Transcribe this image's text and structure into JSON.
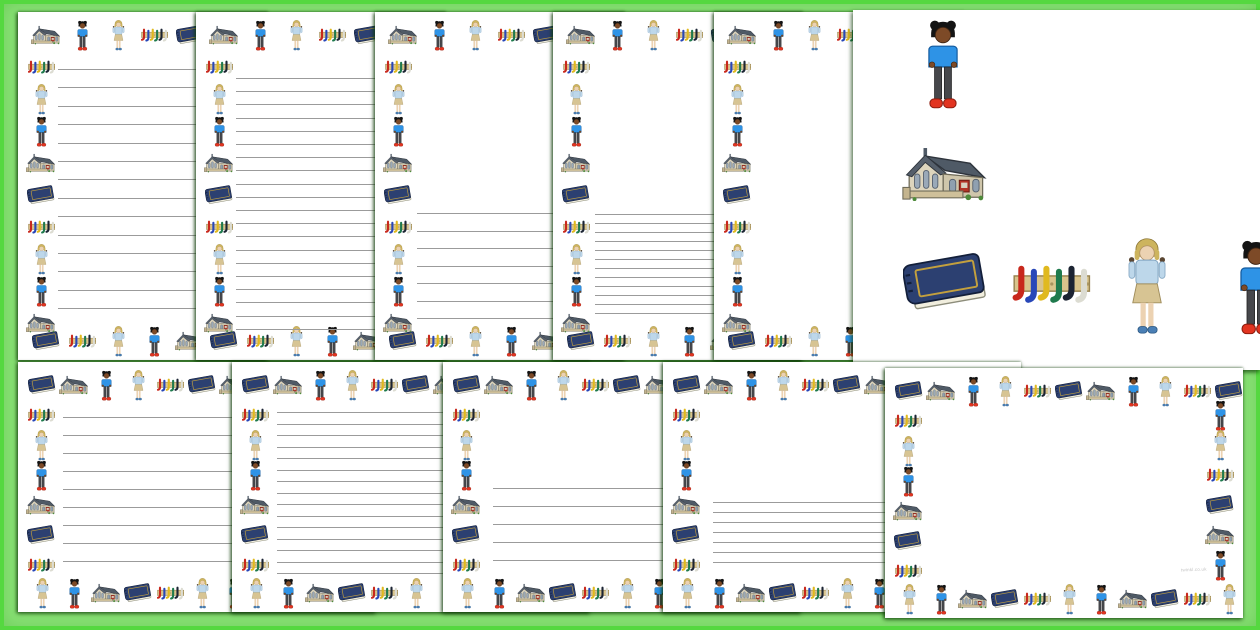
{
  "watermark": "twinkl.co.uk",
  "background": {
    "fill": "#8ae276",
    "frame": "#55d840",
    "page_color": "#ffffff",
    "line_color": "#9b9b9b"
  },
  "icon_cycle": [
    "school",
    "boy",
    "kid",
    "crayons",
    "book"
  ],
  "icon_legend": {
    "school": "school-building",
    "boy": "boy-blue-jumper-red-shoes",
    "kid": "child-waving-blonde",
    "crayons": "peg-rail-coloured-hooks",
    "book": "blue-book"
  },
  "border_templates": {
    "portrait": {
      "top": {
        "start": 0,
        "dir": 1,
        "count": 7,
        "cell": 36,
        "pad": 10
      },
      "left": {
        "start": 3,
        "dir": -1,
        "count": 9,
        "y": 40,
        "step": 32
      },
      "bottom": {
        "start": 4,
        "dir": -1,
        "count": 7,
        "cell": 36,
        "pad": 10
      }
    },
    "landscape": {
      "top": {
        "start": 4,
        "dir": 1,
        "count": 11,
        "cell": 32,
        "pad": 8
      },
      "left": {
        "start": 3,
        "dir": -1,
        "count": 6,
        "y": 38,
        "step": 30
      },
      "bottom": {
        "start": 2,
        "dir": -1,
        "count": 11,
        "cell": 32,
        "pad": 8
      }
    },
    "landscape_full": {
      "top": {
        "start": 4,
        "dir": 1,
        "count": 11,
        "cell": 32,
        "pad": 8
      },
      "left": {
        "start": 3,
        "dir": -1,
        "count": 6,
        "y": 38,
        "step": 30
      },
      "bottom": {
        "start": 2,
        "dir": -1,
        "count": 11,
        "cell": 32,
        "pad": 8
      },
      "right": {
        "start": 1,
        "dir": 1,
        "count": 6,
        "y": 32,
        "step": 30
      }
    }
  },
  "pages": [
    {
      "name": "portrait-wide-lines",
      "left": 18,
      "top": 12,
      "width": 250,
      "height": 348,
      "z": 1,
      "template": "portrait",
      "lines": {
        "count": 14,
        "start": 57,
        "step": 18.4,
        "indent": 40
      }
    },
    {
      "name": "portrait-narrow-lines",
      "left": 196,
      "top": 12,
      "width": 250,
      "height": 348,
      "z": 2,
      "template": "portrait",
      "lines": {
        "count": 20,
        "start": 66,
        "step": 13.2,
        "indent": 40
      }
    },
    {
      "name": "portrait-half-wide-lines",
      "left": 375,
      "top": 12,
      "width": 250,
      "height": 348,
      "z": 3,
      "template": "portrait",
      "lines": {
        "count": 7,
        "start": 201,
        "step": 17.5,
        "indent": 42
      }
    },
    {
      "name": "portrait-half-narrow-lines",
      "left": 553,
      "top": 12,
      "width": 250,
      "height": 348,
      "z": 4,
      "template": "portrait",
      "lines": {
        "count": 12,
        "start": 202,
        "step": 9,
        "indent": 42
      }
    },
    {
      "name": "portrait-blank",
      "left": 714,
      "top": 12,
      "width": 250,
      "height": 348,
      "z": 5,
      "template": "portrait",
      "lines": null
    },
    {
      "name": "landscape-wide-lines",
      "left": 18,
      "top": 362,
      "width": 358,
      "height": 250,
      "z": 11,
      "template": "landscape",
      "lines": {
        "count": 9,
        "start": 55,
        "step": 18,
        "indent": 45
      }
    },
    {
      "name": "landscape-narrow-lines",
      "left": 232,
      "top": 362,
      "width": 358,
      "height": 250,
      "z": 12,
      "template": "landscape",
      "lines": {
        "count": 15,
        "start": 50,
        "step": 11.5,
        "indent": 45
      }
    },
    {
      "name": "landscape-half-wide-lines",
      "left": 443,
      "top": 362,
      "width": 358,
      "height": 250,
      "z": 13,
      "template": "landscape",
      "lines": {
        "count": 5,
        "start": 126,
        "step": 18,
        "indent": 50
      }
    },
    {
      "name": "landscape-half-narrow-lines",
      "left": 663,
      "top": 362,
      "width": 358,
      "height": 250,
      "z": 14,
      "template": "landscape",
      "lines": {
        "count": 7,
        "start": 140,
        "step": 10,
        "indent": 50
      }
    },
    {
      "name": "landscape-blank",
      "left": 885,
      "top": 368,
      "width": 358,
      "height": 250,
      "z": 15,
      "template": "landscape_full",
      "lines": null
    }
  ],
  "panel": {
    "left": 853,
    "top": 10,
    "width": 407,
    "height": 360,
    "z": 8,
    "items": [
      {
        "icon": "boy",
        "x": 72,
        "y": 8,
        "w": 36,
        "h": 92
      },
      {
        "icon": "school",
        "x": 49,
        "y": 132,
        "w": 86,
        "h": 64
      },
      {
        "icon": "book",
        "x": 50,
        "y": 238,
        "w": 85,
        "h": 72
      },
      {
        "icon": "crayons",
        "x": 154,
        "y": 253,
        "w": 86,
        "h": 42
      },
      {
        "icon": "kid",
        "x": 275,
        "y": 228,
        "w": 38,
        "h": 98
      },
      {
        "icon": "boy",
        "x": 384,
        "y": 228,
        "w": 38,
        "h": 98
      }
    ]
  }
}
